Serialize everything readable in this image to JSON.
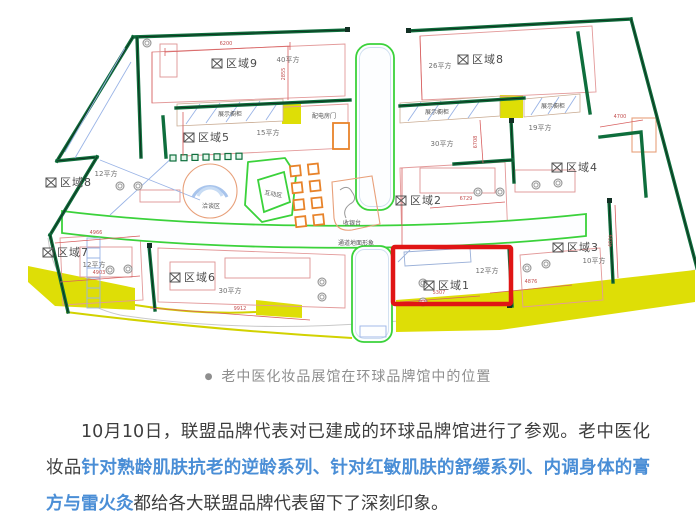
{
  "plan": {
    "zones": [
      {
        "name": "区域9",
        "area": "40平方"
      },
      {
        "name": "区域8",
        "area": "26平方"
      },
      {
        "name": "区域5",
        "area": "15平方"
      },
      {
        "name": "区域4",
        "area": "19平方"
      },
      {
        "name": "区域2",
        "area": "30平方"
      },
      {
        "name": "区域8",
        "area": "12平方"
      },
      {
        "name": "区域7",
        "area": "12平方"
      },
      {
        "name": "区域6",
        "area": "30平方"
      },
      {
        "name": "区域3",
        "area": "10平方"
      },
      {
        "name": "区域1",
        "area": "12平方"
      }
    ],
    "labels": {
      "cabinet_left": "展示橱柜",
      "cabinet_mid": "展示橱柜",
      "cabinet_right": "展示橱柜",
      "power_door": "配电房门",
      "talk_area": "洽谈区",
      "interactive_area": "互动区",
      "cashier": "收银台",
      "corridor_note": "通道地面形象"
    },
    "dims": {
      "d1": "6200",
      "d2": "4700",
      "d3": "6729",
      "d4": "4966",
      "d5": "4903",
      "d6": "9912",
      "d7": "5307",
      "d8": "4876",
      "d9": "6708",
      "d10": "2855",
      "d11": "4039"
    },
    "colors": {
      "wall": "#0e6e3c",
      "path_green": "#3bd23b",
      "highlight_yellow": "#dede06",
      "dimension_red": "#d86060",
      "furniture_orange": "#e8832a",
      "focus_red": "#e01515"
    }
  },
  "caption": {
    "bullet": "●",
    "text": "老中医化妆品展馆在环球品牌馆中的位置"
  },
  "article": {
    "part1": "10月10日，联盟品牌代表对已建成的环球品牌馆进行了参观。老中医化妆品",
    "highlight": "针对熟龄肌肤抗老的逆龄系列、针对红敏肌肤的舒缓系列、内调身体的膏方与雷火灸",
    "part2": "都给各大联盟品牌代表留下了深刻印象。"
  }
}
